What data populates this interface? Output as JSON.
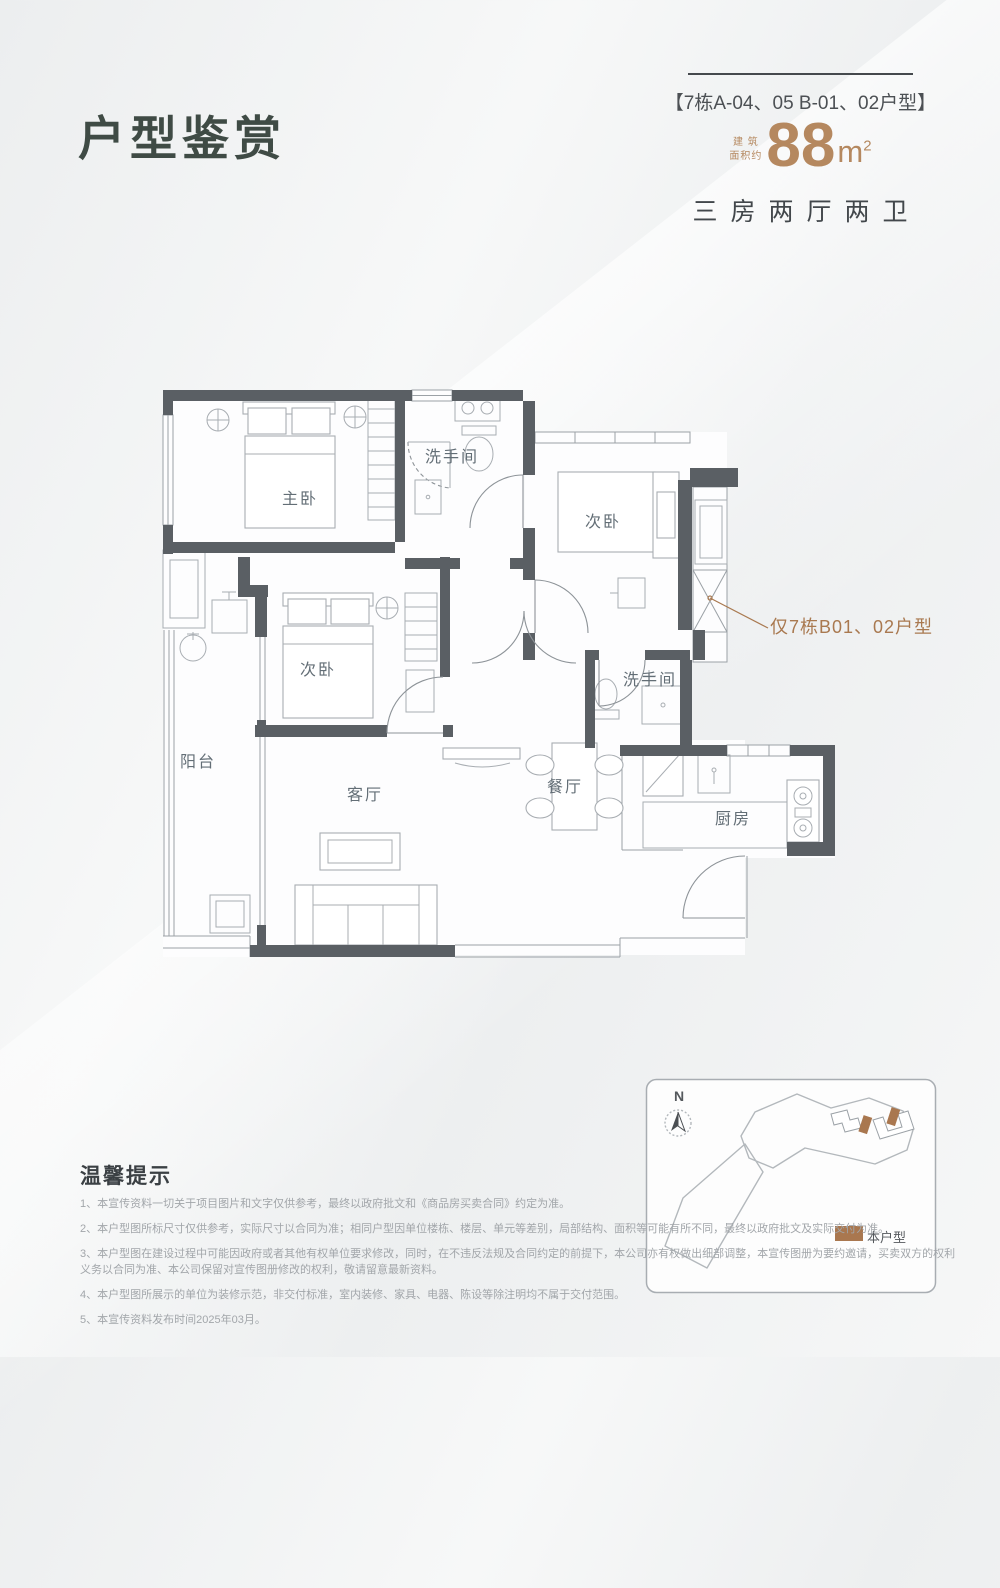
{
  "page": {
    "title": "户型鉴赏"
  },
  "header": {
    "unit_code": "【7栋A-04、05  B-01、02户型】",
    "area_prefix_line1": "建 筑",
    "area_prefix_line2": "面积约",
    "area_value": "88",
    "area_unit": "m",
    "area_sup": "2",
    "layout_desc": "三房两厅两卫"
  },
  "floor_plan": {
    "rooms": [
      {
        "label": "主卧"
      },
      {
        "label": "洗手间"
      },
      {
        "label": "次卧"
      },
      {
        "label": "次卧"
      },
      {
        "label": "阳台"
      },
      {
        "label": "客厅"
      },
      {
        "label": "餐厅"
      },
      {
        "label": "洗手间"
      },
      {
        "label": "厨房"
      }
    ],
    "annotation": "仅7栋B01、02户型"
  },
  "site_map": {
    "compass_label": "N",
    "legend_label": "本户型"
  },
  "notice": {
    "title": "温馨提示",
    "items": [
      "1、本宣传资料一切关于项目图片和文字仅供参考，最终以政府批文和《商品房买卖合同》约定为准。",
      "2、本户型图所标尺寸仅供参考，实际尺寸以合同为准；相同户型因单位楼栋、楼层、单元等差别，局部结构、面积等可能有所不同，最终以政府批文及实际交付为准。",
      "3、本户型图在建设过程中可能因政府或者其他有权单位要求修改，同时，在不违反法规及合同约定的前提下，本公司亦有权做出细部调整，本宣传图册为要约邀请，买卖双方的权利义务以合同为准、本公司保留对宣传图册修改的权利，敬请留意最新资料。",
      "4、本户型图所展示的单位为装修示范，非交付标准，室内装修、家具、电器、陈设等除注明均不属于交付范围。",
      "5、本宣传资料发布时间2025年03月。"
    ]
  },
  "colors": {
    "accent_brown": "#b5885f",
    "annotation_brown": "#a97950",
    "title_green": "#3f4b45",
    "wall_gray": "#5a5f64"
  }
}
